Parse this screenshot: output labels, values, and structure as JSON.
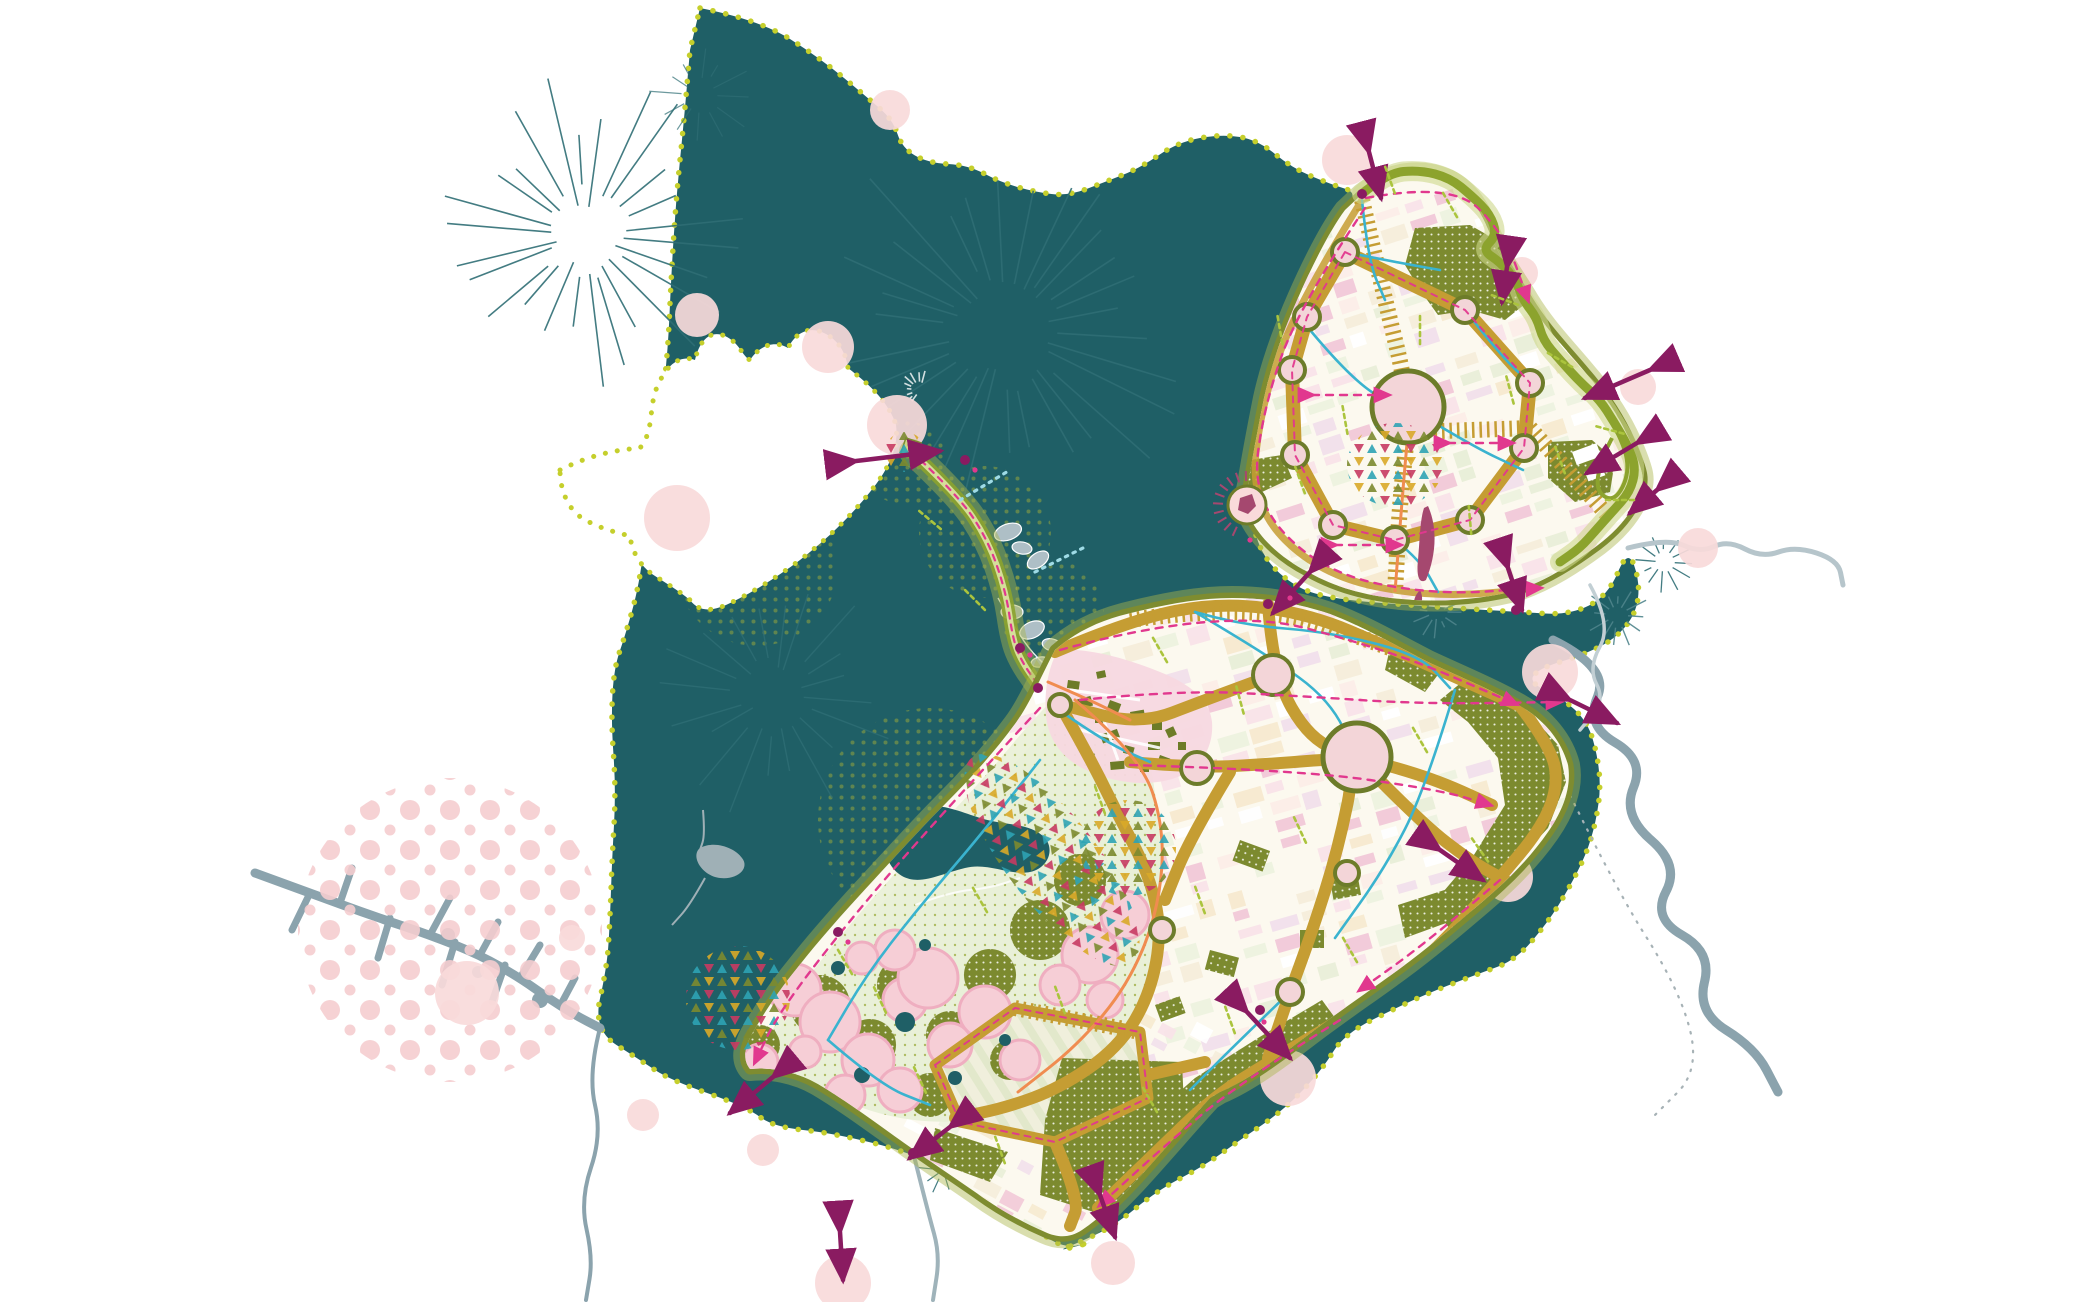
{
  "title": "Island city masterplan strategy map",
  "palette": {
    "background": "#ffffff",
    "water": "#1f5f66",
    "water_rays": "#2f6e75",
    "shore_dots": "#c5cf2c",
    "island": "#fcf9ef",
    "road": "#c59d33",
    "node_ring": "#6d7c2a",
    "node_fill": "#f3d5d8",
    "coast_band": "#7e8c30",
    "coast_halo": "#aab64b",
    "ribbon": "#8ca32d",
    "ribbon_halo": "#cdd78a",
    "park": "#7c8a2f",
    "park_dot": "#ffffff",
    "lagoon": "#e9f0d8",
    "lagoon_dot": "#9fae45",
    "village_pink": "#f7d8e0",
    "village_building": "#6d7c28",
    "tree_fill": "#f6ced6",
    "tree_edge": "#efaec0",
    "magenta": "#e1388e",
    "purple": "#8a1b61",
    "landmark": "#a5486f",
    "cyan": "#3ab3cf",
    "cyan_dotted": "#9fdbe6",
    "orange": "#f08c50",
    "lime": "#abc43d",
    "river_gray": "#8ba3ad",
    "river_light": "#b6c5cb",
    "trail_gray": "#a7b2b6",
    "halftone_pink": "#f5cdcf",
    "halo_pink": "#f9dada",
    "block_colors": [
      "#ffffff",
      "#f9e3e9",
      "#f6eedb",
      "#e9efd8",
      "#fceee8",
      "#f2e0eb",
      "#eef3e0",
      "#f7ead0",
      "#f2c9d8"
    ],
    "confetti_colors": [
      "#c73a62",
      "#2ea3b4",
      "#d9a928",
      "#7c8a2f",
      "#e287a0",
      "#4f7f86"
    ]
  },
  "features": [
    {
      "id": "forest-water-core",
      "label": "dark teal forest-water mass with dotted shoreline"
    },
    {
      "id": "west-bay",
      "label": "white inner bay opening west"
    },
    {
      "id": "north-island",
      "label": "northern district with ring boulevard"
    },
    {
      "id": "ring-boulevard",
      "label": "ochre ring road with junction nodes"
    },
    {
      "id": "central-plaza",
      "label": "central circular plaza"
    },
    {
      "id": "main-island",
      "label": "main district with road grid and park peninsula"
    },
    {
      "id": "causeway-link",
      "label": "green causeway across the water"
    },
    {
      "id": "lagoon-park",
      "label": "lagoon and dotted parkland strip"
    },
    {
      "id": "orchard-grid",
      "label": "trapezoidal field loop with crop rows"
    },
    {
      "id": "village-core",
      "label": "historic village cluster in pink"
    },
    {
      "id": "green-ribbon-edge",
      "label": "green ribbon boundary on open side"
    },
    {
      "id": "tree-canopy-park",
      "label": "pink tree canopies with olive groves"
    },
    {
      "id": "confetti-zones",
      "label": "multicolour triangle activity clusters"
    },
    {
      "id": "connection-arrows",
      "label": "purple double-headed link arrows"
    },
    {
      "id": "creek-west",
      "label": "grey branched creek structure"
    },
    {
      "id": "rivers-east",
      "label": "grey meandering rivers"
    },
    {
      "id": "halftone-grove",
      "label": "pink halftone circle"
    },
    {
      "id": "landmark-sliver",
      "label": "dark-red landmark sliver"
    }
  ]
}
